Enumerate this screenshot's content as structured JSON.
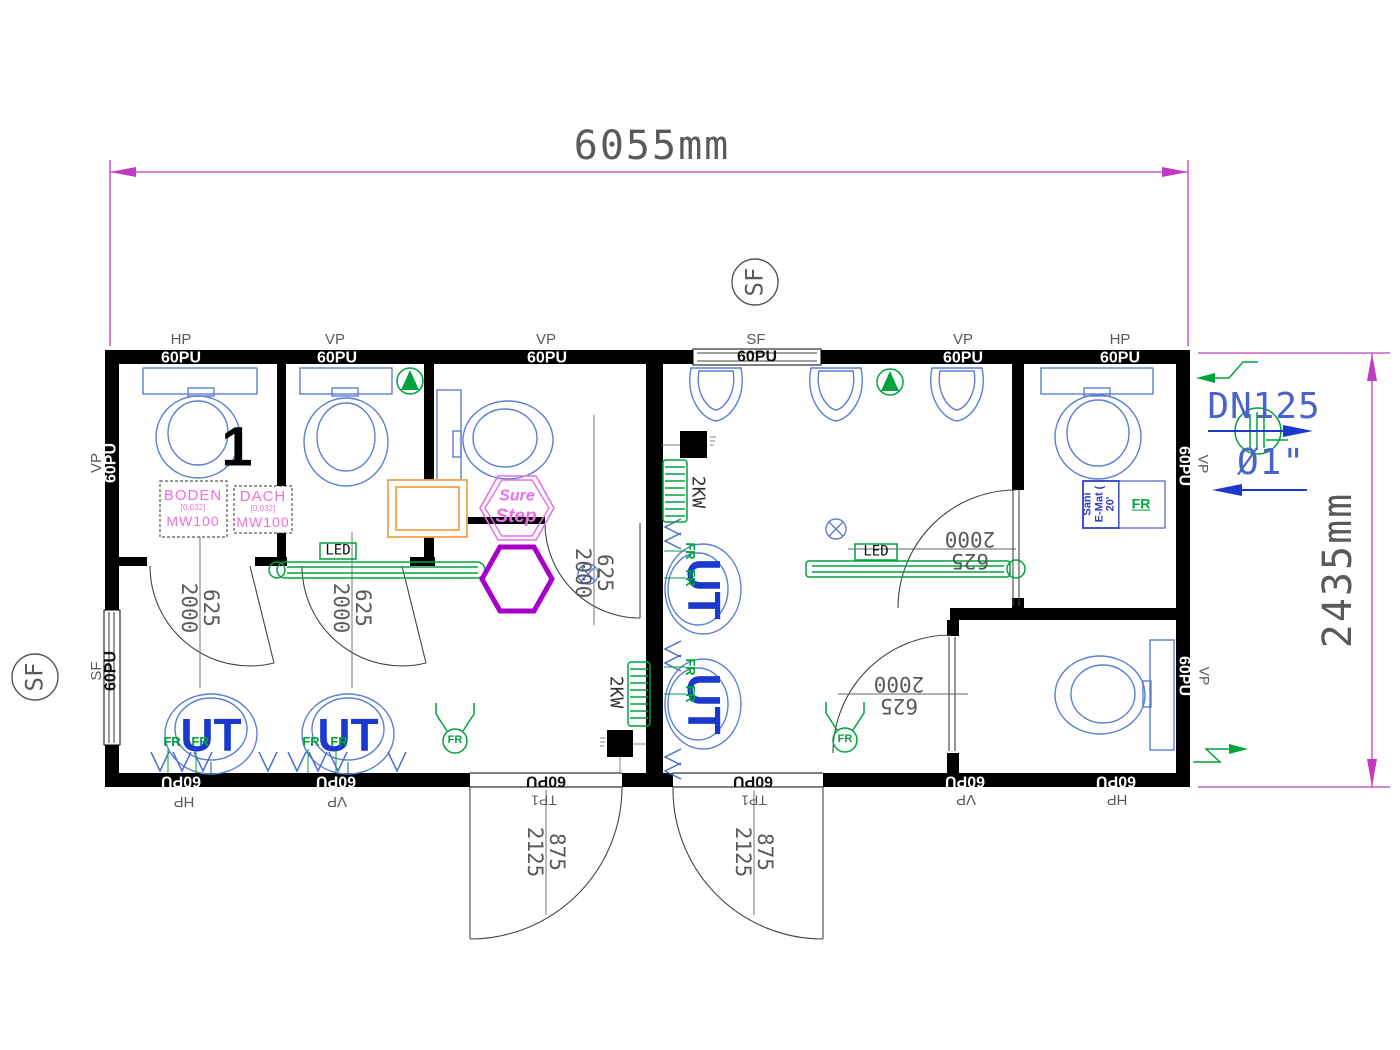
{
  "drawing": {
    "title": "Sanitary container floor plan",
    "width_dim": "6055mm",
    "height_dim": "2435mm",
    "room_number": "1"
  },
  "pipes": {
    "dn": "DN125",
    "dia": "Ø1\""
  },
  "colors": {
    "wall": "#000000",
    "fixture": "#5b7fd4",
    "fixtureBold": "#1c39cf",
    "green": "#00a33c",
    "dimension": "#c23ac2",
    "gray": "#5a5a5a",
    "darkgray": "#333333",
    "pink": "#ef6fd8",
    "hexPink": "#e96fe9",
    "hexPurple": "#a800c8",
    "orange": "#f0a452",
    "saniBlue": "#2d3fc4",
    "pipeBlue": "#4a63cc",
    "white": "#ffffff",
    "black": "#111111"
  },
  "labels": [
    {
      "id": "top-hp-1",
      "t": "HP",
      "x": 181,
      "y": 340,
      "s": 15,
      "c": "gray"
    },
    {
      "id": "top-vp-1",
      "t": "VP",
      "x": 335,
      "y": 340,
      "s": 15,
      "c": "gray"
    },
    {
      "id": "top-vp-2",
      "t": "VP",
      "x": 546,
      "y": 340,
      "s": 15,
      "c": "gray"
    },
    {
      "id": "top-sf",
      "t": "SF",
      "x": 756,
      "y": 340,
      "s": 15,
      "c": "gray"
    },
    {
      "id": "top-vp-3",
      "t": "VP",
      "x": 963,
      "y": 340,
      "s": 15,
      "c": "gray"
    },
    {
      "id": "top-hp-2",
      "t": "HP",
      "x": 1120,
      "y": 340,
      "s": 15,
      "c": "gray"
    },
    {
      "id": "top-60pu-1",
      "t": "60PU",
      "x": 181,
      "y": 359,
      "s": 16,
      "c": "white",
      "w": 1
    },
    {
      "id": "top-60pu-2",
      "t": "60PU",
      "x": 337,
      "y": 359,
      "s": 16,
      "c": "white",
      "w": 1
    },
    {
      "id": "top-60pu-3",
      "t": "60PU",
      "x": 547,
      "y": 359,
      "s": 16,
      "c": "white",
      "w": 1
    },
    {
      "id": "top-60pu-4",
      "t": "60PU",
      "x": 757,
      "y": 358,
      "s": 16,
      "c": "black",
      "w": 1
    },
    {
      "id": "top-60pu-5",
      "t": "60PU",
      "x": 963,
      "y": 359,
      "s": 16,
      "c": "white",
      "w": 1
    },
    {
      "id": "top-60pu-6",
      "t": "60PU",
      "x": 1120,
      "y": 359,
      "s": 16,
      "c": "white",
      "w": 1
    },
    {
      "id": "bottom-60pu-1",
      "t": "60PU",
      "x": 181,
      "y": 780,
      "r": 180,
      "s": 16,
      "c": "white",
      "w": 1
    },
    {
      "id": "bottom-60pu-2",
      "t": "60PU",
      "x": 336,
      "y": 780,
      "r": 180,
      "s": 16,
      "c": "white",
      "w": 1
    },
    {
      "id": "bottom-60pu-3",
      "t": "60PU",
      "x": 546,
      "y": 780,
      "r": 180,
      "s": 16,
      "c": "black",
      "w": 1
    },
    {
      "id": "bottom-60pu-4",
      "t": "60PU",
      "x": 753,
      "y": 780,
      "r": 180,
      "s": 16,
      "c": "black",
      "w": 1
    },
    {
      "id": "bottom-60pu-5",
      "t": "60PU",
      "x": 965,
      "y": 780,
      "r": 180,
      "s": 16,
      "c": "white",
      "w": 1
    },
    {
      "id": "bottom-60pu-6",
      "t": "60PU",
      "x": 1116,
      "y": 780,
      "r": 180,
      "s": 16,
      "c": "white",
      "w": 1
    },
    {
      "id": "bottom-hp-1",
      "t": "HP",
      "x": 184,
      "y": 801,
      "r": 180,
      "s": 15,
      "c": "gray"
    },
    {
      "id": "bottom-vp-1",
      "t": "VP",
      "x": 337,
      "y": 801,
      "r": 180,
      "s": 15,
      "c": "gray"
    },
    {
      "id": "bottom-tp1-1",
      "t": "TP1",
      "x": 544,
      "y": 800,
      "r": 180,
      "s": 14,
      "c": "gray"
    },
    {
      "id": "bottom-tp1-2",
      "t": "TP1",
      "x": 754,
      "y": 800,
      "r": 180,
      "s": 14,
      "c": "gray"
    },
    {
      "id": "bottom-vp-2",
      "t": "VP",
      "x": 966,
      "y": 799,
      "r": 180,
      "s": 15,
      "c": "gray"
    },
    {
      "id": "bottom-hp-2",
      "t": "HP",
      "x": 1117,
      "y": 799,
      "r": 180,
      "s": 15,
      "c": "gray"
    },
    {
      "id": "left-vp",
      "t": "VP",
      "x": 97,
      "y": 463,
      "r": -90,
      "s": 15,
      "c": "gray"
    },
    {
      "id": "left-60pu-1",
      "t": "60PU",
      "x": 112,
      "y": 463,
      "r": -90,
      "s": 16,
      "c": "white",
      "w": 1
    },
    {
      "id": "left-sf",
      "t": "SF",
      "x": 97,
      "y": 671,
      "r": -90,
      "s": 15,
      "c": "gray"
    },
    {
      "id": "left-60pu-2",
      "t": "60PU",
      "x": 112,
      "y": 671,
      "r": -90,
      "s": 16,
      "c": "black",
      "w": 1
    },
    {
      "id": "right-60pu-1",
      "t": "60PU",
      "x": 1183,
      "y": 466,
      "r": 90,
      "s": 16,
      "c": "white",
      "w": 1
    },
    {
      "id": "right-vp-1",
      "t": "VP",
      "x": 1203,
      "y": 464,
      "r": 90,
      "s": 14,
      "c": "gray"
    },
    {
      "id": "right-60pu-2",
      "t": "60PU",
      "x": 1183,
      "y": 676,
      "r": 90,
      "s": 16,
      "c": "white",
      "w": 1
    },
    {
      "id": "right-vp-2",
      "t": "VP",
      "x": 1204,
      "y": 676,
      "r": 90,
      "s": 14,
      "c": "gray"
    },
    {
      "id": "sf-marker-top-label",
      "t": "SF",
      "x": 755,
      "y": 282,
      "r": -90,
      "s": 24,
      "c": "gray",
      "m": 1
    },
    {
      "id": "sf-marker-left-label",
      "t": "SF",
      "x": 35,
      "y": 677,
      "r": -90,
      "s": 24,
      "c": "gray",
      "m": 1
    },
    {
      "id": "door-dim-1",
      "ls": [
        "625",
        "2000"
      ],
      "x": 200,
      "y": 608,
      "r": 90,
      "s": 21,
      "c": "gray",
      "m": 1
    },
    {
      "id": "door-dim-2",
      "ls": [
        "625",
        "2000"
      ],
      "x": 352,
      "y": 608,
      "r": 90,
      "s": 21,
      "c": "gray",
      "m": 1
    },
    {
      "id": "door-dim-3",
      "ls": [
        "625",
        "2000"
      ],
      "x": 594,
      "y": 573,
      "r": 90,
      "s": 21,
      "c": "gray",
      "m": 1
    },
    {
      "id": "door-dim-4",
      "ls": [
        "625",
        "2000"
      ],
      "x": 970,
      "y": 550,
      "r": 180,
      "s": 21,
      "c": "gray",
      "m": 1
    },
    {
      "id": "door-dim-5",
      "ls": [
        "625",
        "2000"
      ],
      "x": 899,
      "y": 695,
      "r": 180,
      "s": 21,
      "c": "gray",
      "m": 1
    },
    {
      "id": "entry-dim-1",
      "ls": [
        "875",
        "2125"
      ],
      "x": 546,
      "y": 852,
      "r": 90,
      "s": 21,
      "c": "gray",
      "m": 1
    },
    {
      "id": "entry-dim-2",
      "ls": [
        "875",
        "2125"
      ],
      "x": 754,
      "y": 852,
      "r": 90,
      "s": 21,
      "c": "gray",
      "m": 1
    },
    {
      "id": "heater-label-1",
      "t": "2KW",
      "x": 615,
      "y": 692,
      "r": 90,
      "s": 18,
      "c": "darkgray",
      "m": 1
    },
    {
      "id": "heater-label-2",
      "t": "2KW",
      "x": 697,
      "y": 492,
      "r": 90,
      "s": 18,
      "c": "darkgray",
      "m": 1
    },
    {
      "id": "urinal-label-1",
      "t": "UT",
      "x": 211,
      "y": 735,
      "s": 46,
      "c": "fixtureBold",
      "w": 1
    },
    {
      "id": "urinal-label-2",
      "t": "UT",
      "x": 348,
      "y": 735,
      "s": 46,
      "c": "fixtureBold",
      "w": 1
    },
    {
      "id": "urinal-label-3",
      "t": "UT",
      "x": 704,
      "y": 589,
      "r": 90,
      "s": 46,
      "c": "fixtureBold",
      "w": 1
    },
    {
      "id": "urinal-label-4",
      "t": "UT",
      "x": 704,
      "y": 704,
      "r": 90,
      "s": 46,
      "c": "fixtureBold",
      "w": 1
    },
    {
      "id": "fr-1",
      "t": "FR",
      "x": 172,
      "y": 742,
      "s": 13,
      "c": "green",
      "w": 1
    },
    {
      "id": "fr-2",
      "t": "FR",
      "x": 200,
      "y": 742,
      "s": 13,
      "c": "green",
      "w": 1
    },
    {
      "id": "fr-3",
      "t": "FR",
      "x": 311,
      "y": 742,
      "s": 13,
      "c": "green",
      "w": 1
    },
    {
      "id": "fr-4",
      "t": "FR",
      "x": 339,
      "y": 742,
      "s": 13,
      "c": "green",
      "w": 1
    },
    {
      "id": "fr-5",
      "t": "FR",
      "x": 690,
      "y": 551,
      "r": 90,
      "s": 13,
      "c": "green",
      "w": 1
    },
    {
      "id": "fr-6",
      "t": "FR",
      "x": 690,
      "y": 578,
      "r": 90,
      "s": 13,
      "c": "green",
      "w": 1
    },
    {
      "id": "fr-7",
      "t": "FR",
      "x": 690,
      "y": 667,
      "r": 90,
      "s": 13,
      "c": "green",
      "w": 1
    },
    {
      "id": "fr-8",
      "t": "FR",
      "x": 690,
      "y": 694,
      "r": 90,
      "s": 13,
      "c": "green",
      "w": 1
    },
    {
      "id": "fr-sensor-label-1",
      "t": "FR",
      "x": 455,
      "y": 741,
      "s": 11,
      "c": "green",
      "w": 1
    },
    {
      "id": "fr-sensor-label-2",
      "t": "FR",
      "x": 845,
      "y": 740,
      "s": 11,
      "c": "green",
      "w": 1
    },
    {
      "id": "fr-sani",
      "t": "FR",
      "x": 1141,
      "y": 504,
      "s": 14,
      "c": "green",
      "w": 1,
      "u": 1
    },
    {
      "id": "led-label-1",
      "t": "LED",
      "x": 338,
      "y": 551,
      "s": 14,
      "c": "black",
      "m": 1
    },
    {
      "id": "led-label-2",
      "t": "LED",
      "x": 876,
      "y": 552,
      "s": 14,
      "c": "black",
      "m": 1
    },
    {
      "id": "surestep-line-1",
      "t": "Sure",
      "x": 517,
      "y": 497,
      "s": 16,
      "c": "hexPink",
      "w": 1,
      "i": 1
    },
    {
      "id": "surestep-line-2",
      "t": "Step",
      "x": 516,
      "y": 517,
      "s": 19,
      "c": "hexPink",
      "w": 1,
      "i": 1
    },
    {
      "id": "boden-box",
      "ls": [
        "BODEN",
        "[0,032]",
        "MW100"
      ],
      "x": 193,
      "y": 508,
      "c": "pink",
      "cls": "insul"
    },
    {
      "id": "dach-box",
      "ls": [
        "DACH",
        "[0,032]",
        "MW100"
      ],
      "x": 263,
      "y": 509,
      "c": "pink",
      "cls": "insul"
    },
    {
      "id": "sani-box-label",
      "ls": [
        "Sani",
        "E-Mat (",
        "20'"
      ],
      "x": 1100,
      "y": 504,
      "r": -90,
      "s": 11,
      "c": "saniBlue",
      "w": 1
    }
  ]
}
